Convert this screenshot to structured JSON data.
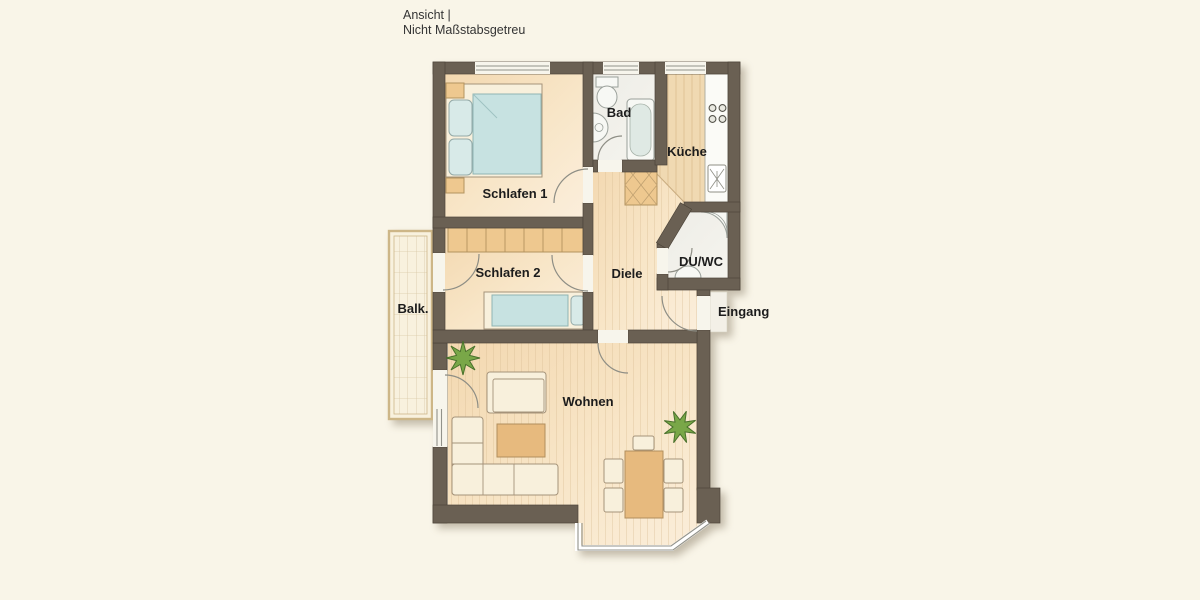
{
  "header": {
    "line1": "Ansicht |",
    "line2": "Nicht Maßstabsgetreu"
  },
  "rooms": {
    "schlafen1": "Schlafen 1",
    "schlafen2": "Schlafen 2",
    "bad": "Bad",
    "kueche": "Küche",
    "diele": "Diele",
    "duwc": "DU/WC",
    "balkon": "Balk.",
    "wohnen": "Wohnen"
  },
  "annotations": {
    "eingang": "Eingang"
  },
  "palette": {
    "background": "#f9f5e8",
    "wall": "#6a6053",
    "floor_warm": "#f6e2c0",
    "floor_wood": "#f0d9b2",
    "floor_wet": "#f2f1ec",
    "furniture_wood": "#eec88f",
    "furniture_fabric": "#f8f0dc",
    "bed_blanket": "#c7e2e1",
    "plant_green": "#79a748",
    "balcony_floor": "#f8f1de",
    "window_line": "#92928a",
    "label_text": "#1c1c1c"
  }
}
